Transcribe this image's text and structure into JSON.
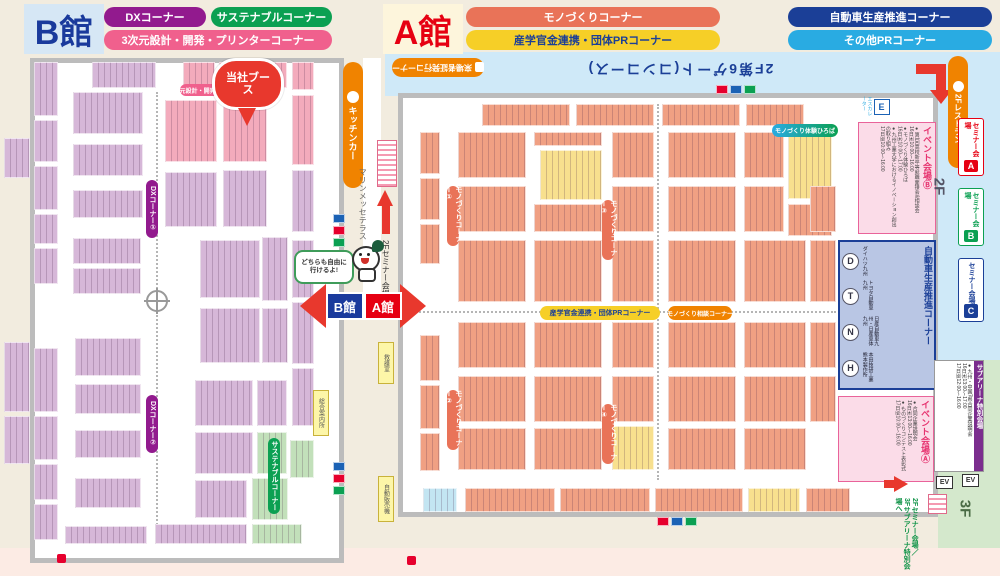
{
  "halls": {
    "b_title": "B館",
    "a_title": "A館"
  },
  "legend_b": [
    {
      "label": "DXコーナー",
      "color": "#921a8e"
    },
    {
      "label": "サステナブルコーナー",
      "color": "#0ba052"
    },
    {
      "label": "3次元設計・開発・プリンターコーナー",
      "color": "#f0608d"
    }
  ],
  "legend_a": [
    {
      "label": "モノづくりコーナー",
      "color": "#e97358"
    },
    {
      "label": "自動車生産推進コーナー",
      "color": "#1b3f97"
    },
    {
      "label": "産学官金連携・団体PRコーナー",
      "color": "#f6cf27"
    },
    {
      "label": "その他PRコーナー",
      "color": "#29abe2"
    }
  ],
  "mid": {
    "kitchen_car": "キッチンカー",
    "terrace": "マリンメッセテラス",
    "to_seminar_2f": "2Fセミナー会場へ",
    "bubble": "どちらも自由に行けるよ!",
    "arrow_b": "B館",
    "arrow_a": "A館"
  },
  "b_map": {
    "pin": "当社ブース",
    "strip_3d": "3次元設計・開発・プリンターコーナー",
    "dx1": "DXコーナー①",
    "dx2": "DXコーナー②",
    "sustainable": "サステナブルコーナー",
    "info_tag": "総合案内所"
  },
  "a_map": {
    "visitor_badge": "来場者証発行コーナー",
    "gate_note": "2F第6ゲート(コンコース)",
    "mono_pills": [
      "モノづくりコーナー①",
      "モノづくりコーナー②",
      "モノづくりコーナー③",
      "モノづくりコーナー④"
    ],
    "sangaku_strip": "産学官金連携・団体PRコーナー",
    "teal_strip": "モノづくり体験ひろば",
    "orange_strip": "モノづくり相談コーナー",
    "rescue_tag": "救護室",
    "vending_tag": "自動販売機",
    "escalator": {
      "letter": "E",
      "label": "エスカレーター"
    },
    "event_b": {
      "title": "イベント会場Ⓑ",
      "lines": "●第1回高校新卒等就職面接会&相談会\n16日㈭10:00〜16:00\n●モノづくり体験ひろば\n16日㈭10:00〜17:00\n●九州工業大学におけるイノベーション創出の取り組み\n17日㈮10:00〜16:00"
    },
    "event_a": {
      "title": "イベント会場Ⓐ",
      "lines": "●合同企業説明会\n16日㈭13:00〜16:00\n●ものづくりコンテスト表彰式\n17日㈮10:00〜16:00"
    },
    "auto_corner": {
      "title": "自動車生産推進コーナー",
      "makers": [
        {
          "letter": "D",
          "name": "ダイハツ九州"
        },
        {
          "letter": "T",
          "name": "トヨタ自動車九州"
        },
        {
          "letter": "N",
          "name": "日産自動車九州・日産車体九州"
        },
        {
          "letter": "H",
          "name": "本田技研工業 熊本製作所"
        }
      ]
    }
  },
  "right_side": {
    "restaurant": "2Fレストラン",
    "floor2": "2F",
    "floor3": "3F",
    "ev": "EV",
    "seminar_rooms": [
      {
        "label": "セミナー会場",
        "letter": "A",
        "color": "#e60012"
      },
      {
        "label": "セミナー会場",
        "letter": "B",
        "color": "#0ba052"
      },
      {
        "label": "セミナー会場",
        "letter": "C",
        "color": "#1b3f97"
      }
    ],
    "subarena": {
      "title": "サブアリーナ特別会場",
      "lines": "●九州・中国7県合同企業説明会\n16日㈭13:00〜17:00\n17日㈮12:00〜16:00"
    },
    "to_3f": "2Fセミナー会場／\n3Fサブアリーナ特別会場へ"
  },
  "palette": {
    "p": "#d6b7d8",
    "k": "#f3abbc",
    "g": "#c2e0ba",
    "y": "#f8e08e",
    "s": "#f0a083",
    "c": "#c3e5f2"
  },
  "b_booths": [
    [
      34,
      62,
      24,
      54,
      "p"
    ],
    [
      34,
      120,
      24,
      42,
      "p"
    ],
    [
      34,
      166,
      24,
      44,
      "p"
    ],
    [
      34,
      214,
      24,
      30,
      "p"
    ],
    [
      34,
      248,
      24,
      36,
      "p"
    ],
    [
      34,
      348,
      24,
      64,
      "p"
    ],
    [
      34,
      416,
      24,
      44,
      "p"
    ],
    [
      34,
      464,
      24,
      36,
      "p"
    ],
    [
      34,
      504,
      24,
      36,
      "p"
    ],
    [
      4,
      138,
      26,
      40,
      "p"
    ],
    [
      4,
      342,
      26,
      70,
      "p"
    ],
    [
      4,
      416,
      26,
      48,
      "p"
    ],
    [
      92,
      62,
      64,
      26,
      "p"
    ],
    [
      183,
      62,
      32,
      26,
      "k"
    ],
    [
      219,
      62,
      46,
      26,
      "k"
    ],
    [
      269,
      62,
      18,
      26,
      "k"
    ],
    [
      292,
      62,
      22,
      28,
      "k"
    ],
    [
      73,
      92,
      70,
      42,
      "p"
    ],
    [
      73,
      144,
      70,
      32,
      "p"
    ],
    [
      73,
      190,
      70,
      28,
      "p"
    ],
    [
      73,
      238,
      68,
      26,
      "p"
    ],
    [
      73,
      268,
      68,
      26,
      "p"
    ],
    [
      165,
      100,
      52,
      62,
      "k"
    ],
    [
      223,
      100,
      44,
      62,
      "k"
    ],
    [
      292,
      95,
      22,
      70,
      "k"
    ],
    [
      165,
      172,
      52,
      55,
      "p"
    ],
    [
      223,
      170,
      44,
      57,
      "p"
    ],
    [
      292,
      170,
      22,
      62,
      "p"
    ],
    [
      200,
      240,
      60,
      58,
      "p"
    ],
    [
      262,
      237,
      26,
      64,
      "p"
    ],
    [
      292,
      240,
      22,
      58,
      "p"
    ],
    [
      200,
      308,
      60,
      55,
      "p"
    ],
    [
      262,
      308,
      26,
      55,
      "p"
    ],
    [
      292,
      302,
      22,
      62,
      "p"
    ],
    [
      75,
      338,
      66,
      38,
      "p"
    ],
    [
      75,
      384,
      66,
      30,
      "p"
    ],
    [
      75,
      430,
      66,
      28,
      "p"
    ],
    [
      75,
      478,
      66,
      30,
      "p"
    ],
    [
      65,
      526,
      82,
      18,
      "p"
    ],
    [
      195,
      380,
      58,
      46,
      "p"
    ],
    [
      257,
      380,
      30,
      46,
      "p"
    ],
    [
      292,
      368,
      22,
      58,
      "p"
    ],
    [
      195,
      432,
      58,
      42,
      "p"
    ],
    [
      257,
      432,
      30,
      42,
      "g"
    ],
    [
      290,
      440,
      24,
      38,
      "g"
    ],
    [
      195,
      480,
      52,
      38,
      "p"
    ],
    [
      252,
      478,
      36,
      42,
      "g"
    ],
    [
      155,
      524,
      92,
      20,
      "p"
    ],
    [
      252,
      524,
      50,
      20,
      "g"
    ]
  ],
  "a_booths": [
    [
      482,
      104,
      88,
      22,
      "s"
    ],
    [
      576,
      104,
      78,
      22,
      "s"
    ],
    [
      662,
      104,
      78,
      22,
      "s"
    ],
    [
      746,
      104,
      58,
      22,
      "s"
    ],
    [
      420,
      132,
      20,
      42,
      "s"
    ],
    [
      420,
      178,
      20,
      42,
      "s"
    ],
    [
      420,
      224,
      20,
      40,
      "s"
    ],
    [
      420,
      335,
      20,
      46,
      "s"
    ],
    [
      420,
      385,
      20,
      44,
      "s"
    ],
    [
      420,
      433,
      20,
      38,
      "s"
    ],
    [
      458,
      132,
      68,
      46,
      "s"
    ],
    [
      458,
      186,
      68,
      46,
      "s"
    ],
    [
      458,
      240,
      68,
      62,
      "s"
    ],
    [
      458,
      322,
      68,
      46,
      "s"
    ],
    [
      458,
      376,
      68,
      46,
      "s"
    ],
    [
      458,
      428,
      68,
      42,
      "s"
    ],
    [
      534,
      132,
      68,
      14,
      "s"
    ],
    [
      540,
      150,
      62,
      50,
      "y"
    ],
    [
      534,
      204,
      68,
      28,
      "s"
    ],
    [
      534,
      240,
      68,
      62,
      "s"
    ],
    [
      534,
      322,
      68,
      46,
      "s"
    ],
    [
      534,
      376,
      68,
      46,
      "s"
    ],
    [
      534,
      428,
      68,
      42,
      "s"
    ],
    [
      612,
      132,
      42,
      46,
      "s"
    ],
    [
      612,
      186,
      42,
      46,
      "s"
    ],
    [
      612,
      240,
      42,
      62,
      "s"
    ],
    [
      612,
      322,
      42,
      46,
      "s"
    ],
    [
      612,
      376,
      42,
      46,
      "s"
    ],
    [
      612,
      426,
      42,
      44,
      "y"
    ],
    [
      668,
      132,
      68,
      46,
      "s"
    ],
    [
      668,
      186,
      68,
      46,
      "s"
    ],
    [
      668,
      240,
      68,
      62,
      "s"
    ],
    [
      668,
      322,
      68,
      46,
      "s"
    ],
    [
      668,
      376,
      68,
      46,
      "s"
    ],
    [
      668,
      428,
      68,
      42,
      "s"
    ],
    [
      744,
      132,
      40,
      46,
      "s"
    ],
    [
      788,
      135,
      44,
      64,
      "y"
    ],
    [
      744,
      186,
      40,
      46,
      "s"
    ],
    [
      788,
      204,
      44,
      32,
      "s"
    ],
    [
      744,
      240,
      62,
      62,
      "s"
    ],
    [
      744,
      322,
      62,
      46,
      "s"
    ],
    [
      744,
      376,
      62,
      46,
      "s"
    ],
    [
      744,
      428,
      62,
      42,
      "s"
    ],
    [
      810,
      186,
      26,
      46,
      "s"
    ],
    [
      810,
      240,
      26,
      62,
      "s"
    ],
    [
      810,
      322,
      26,
      46,
      "s"
    ],
    [
      810,
      376,
      26,
      46,
      "s"
    ],
    [
      423,
      488,
      34,
      24,
      "c"
    ],
    [
      465,
      488,
      90,
      24,
      "s"
    ],
    [
      560,
      488,
      90,
      24,
      "s"
    ],
    [
      655,
      488,
      88,
      24,
      "s"
    ],
    [
      748,
      488,
      52,
      24,
      "y"
    ],
    [
      806,
      488,
      44,
      24,
      "s"
    ]
  ],
  "amenity_clusters": [
    {
      "x": 333,
      "y": 214,
      "dir": "v",
      "colors": [
        "#1b62b5",
        "#e6002d",
        "#0ba052"
      ]
    },
    {
      "x": 333,
      "y": 462,
      "dir": "v",
      "colors": [
        "#1b62b5",
        "#e6002d",
        "#0ba052"
      ]
    },
    {
      "x": 716,
      "y": 85,
      "dir": "h",
      "colors": [
        "#e6002d",
        "#1b62b5",
        "#0ba052"
      ]
    },
    {
      "x": 657,
      "y": 517,
      "dir": "h",
      "colors": [
        "#e6002d",
        "#1b62b5",
        "#0ba052"
      ]
    }
  ],
  "markers": [
    [
      57,
      554
    ],
    [
      407,
      556
    ]
  ]
}
